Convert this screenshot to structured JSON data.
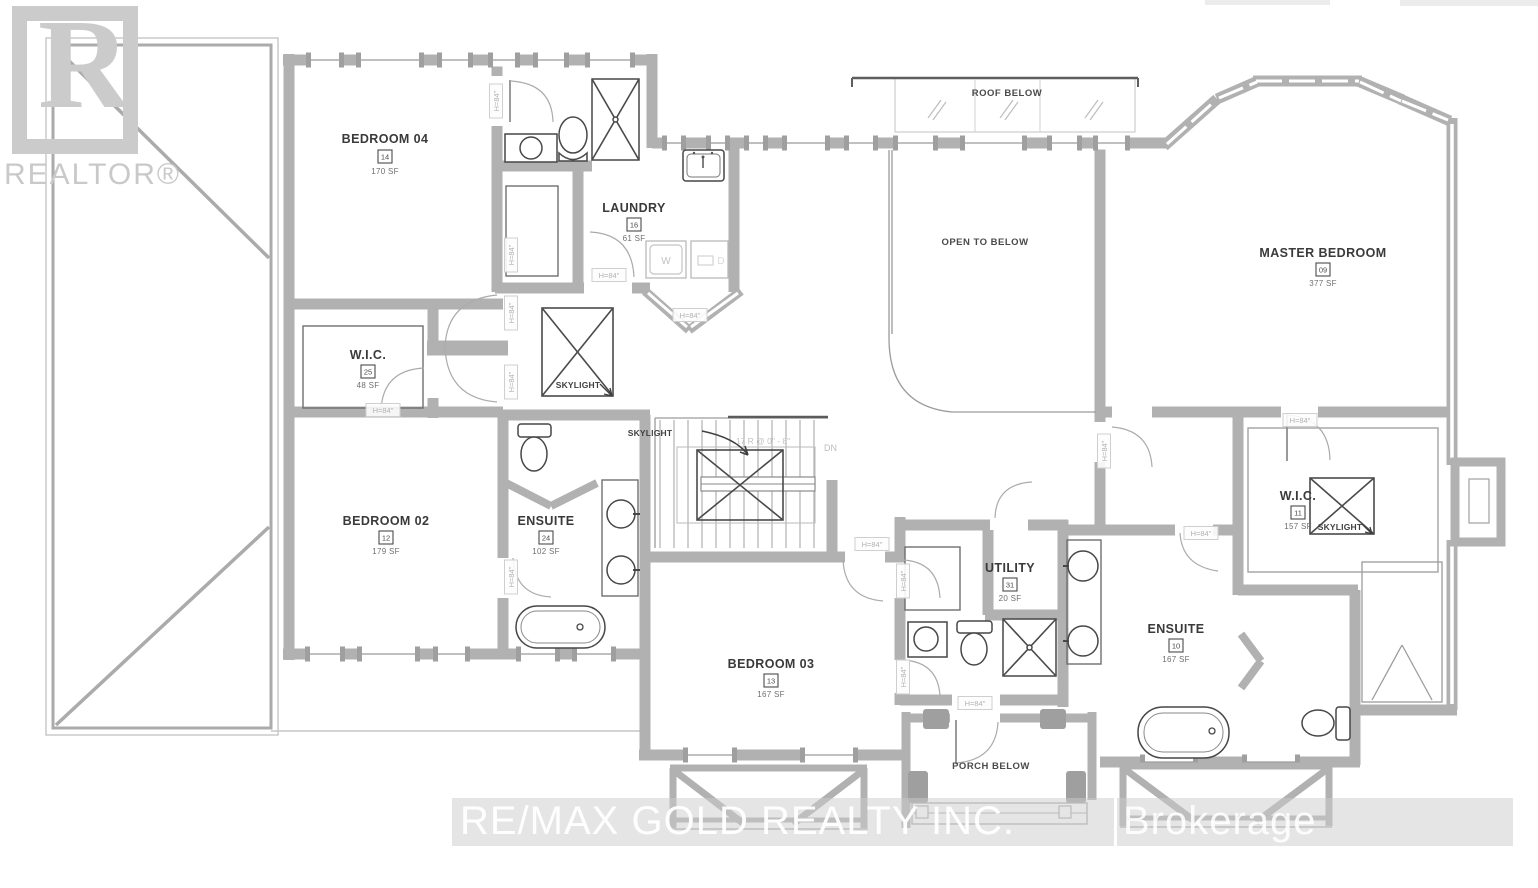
{
  "watermarks": {
    "logo_letter": "R",
    "realtor": "REALTOR®",
    "brokerage_main": "RE/MAX GOLD REALTY INC.",
    "brokerage_suffix": "Brokerage"
  },
  "rooms": [
    {
      "name": "BEDROOM 04",
      "number": "14",
      "area": "170 SF"
    },
    {
      "name": "LAUNDRY",
      "number": "16",
      "area": "61 SF"
    },
    {
      "name": "W.I.C.",
      "number": "25",
      "area": "48 SF"
    },
    {
      "name": "BEDROOM 02",
      "number": "12",
      "area": "179 SF"
    },
    {
      "name": "ENSUITE",
      "number": "24",
      "area": "102 SF"
    },
    {
      "name": "MASTER BEDROOM",
      "number": "09",
      "area": "377 SF"
    },
    {
      "name": "W.I.C.",
      "number": "11",
      "area": "157 SF"
    },
    {
      "name": "UTILITY",
      "number": "31",
      "area": "20 SF"
    },
    {
      "name": "ENSUITE",
      "number": "10",
      "area": "167 SF"
    },
    {
      "name": "BEDROOM 03",
      "number": "13",
      "area": "167 SF"
    }
  ],
  "annotations": {
    "open_to_below": "OPEN TO BELOW",
    "roof_below": "ROOF BELOW",
    "porch_below": "PORCH BELOW",
    "skylight": "SKYLIGHT",
    "down": "DN",
    "stair_note": "17 R @ 0\" - 8\"",
    "door_height": "H=84\"",
    "washer": "W",
    "dryer": "D"
  },
  "colors": {
    "wall": "#b1b1b1",
    "thin_line": "#9c9c9c",
    "fixture": "#474747",
    "label": "#3a3a3a",
    "muted_label": "#b2b2b2",
    "watermark": "#cbcbcb"
  }
}
